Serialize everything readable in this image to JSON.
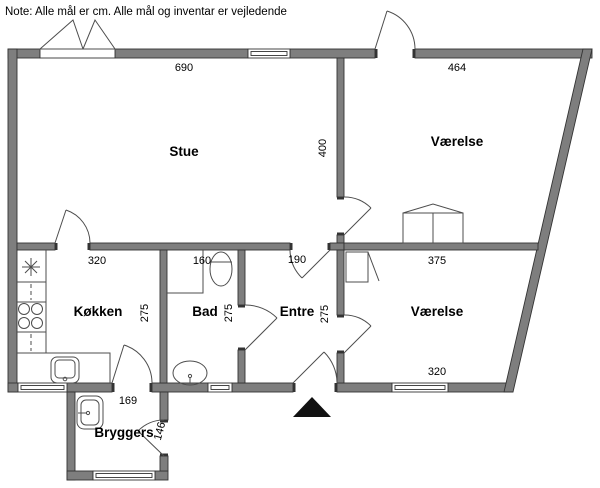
{
  "note": "Note: Alle mål er cm. Alle mål og inventar er vejledende",
  "colors": {
    "wall": "#7e7e7e",
    "outline": "#333333",
    "line": "#4d4d4d",
    "text": "#000000",
    "background": "#ffffff",
    "arrow": "#111111"
  },
  "rooms": {
    "stue": {
      "name": "Stue",
      "width_cm": "690",
      "depth_cm": "400"
    },
    "vaerelse_nord": {
      "name": "Værelse",
      "width_cm": "464"
    },
    "koekken": {
      "name": "Køkken",
      "width_cm": "320",
      "depth_cm": "275"
    },
    "bad": {
      "name": "Bad",
      "width_cm": "160",
      "depth_cm": "275"
    },
    "entre": {
      "name": "Entre",
      "width_cm": "190",
      "depth_cm": "275"
    },
    "vaerelse_syd": {
      "name": "Værelse",
      "width_top_cm": "375",
      "width_bottom_cm": "320"
    },
    "bryggers": {
      "name": "Bryggers",
      "width_cm": "169",
      "door_cm": "146"
    }
  }
}
